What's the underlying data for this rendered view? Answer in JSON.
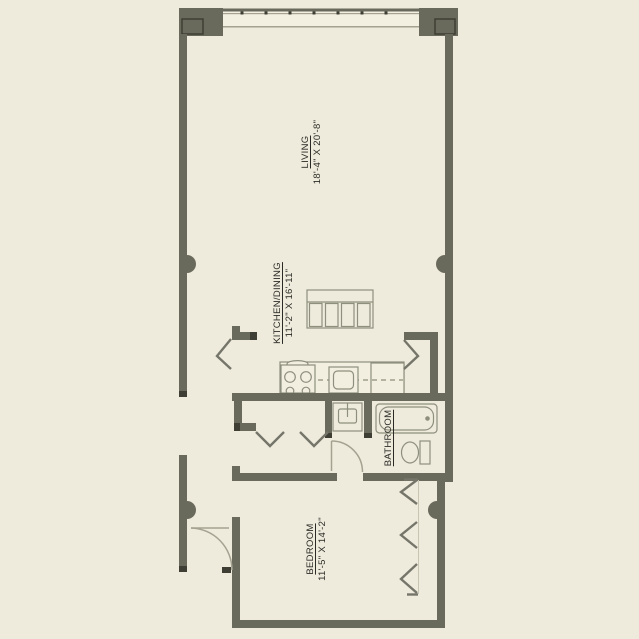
{
  "theme": {
    "bg": "#eeebdc",
    "band": "#f3f0e2",
    "wall": "#6a6a5c",
    "wall_dark": "#3e3e35",
    "line": "#8f8f7e",
    "chevron": "#75756a",
    "text": "#2b2b26"
  },
  "rooms": [
    {
      "id": "living",
      "name": "LIVING",
      "dims": "18'-4\" X 20'-8\""
    },
    {
      "id": "kitchen",
      "name": "KITCHEN/DINING",
      "dims": "11'-2\" X 16'-11\""
    },
    {
      "id": "bathroom",
      "name": "BATHROOM",
      "dims": ""
    },
    {
      "id": "bedroom",
      "name": "BEDROOM",
      "dims": "11'-5\" X 14'-2\""
    }
  ]
}
